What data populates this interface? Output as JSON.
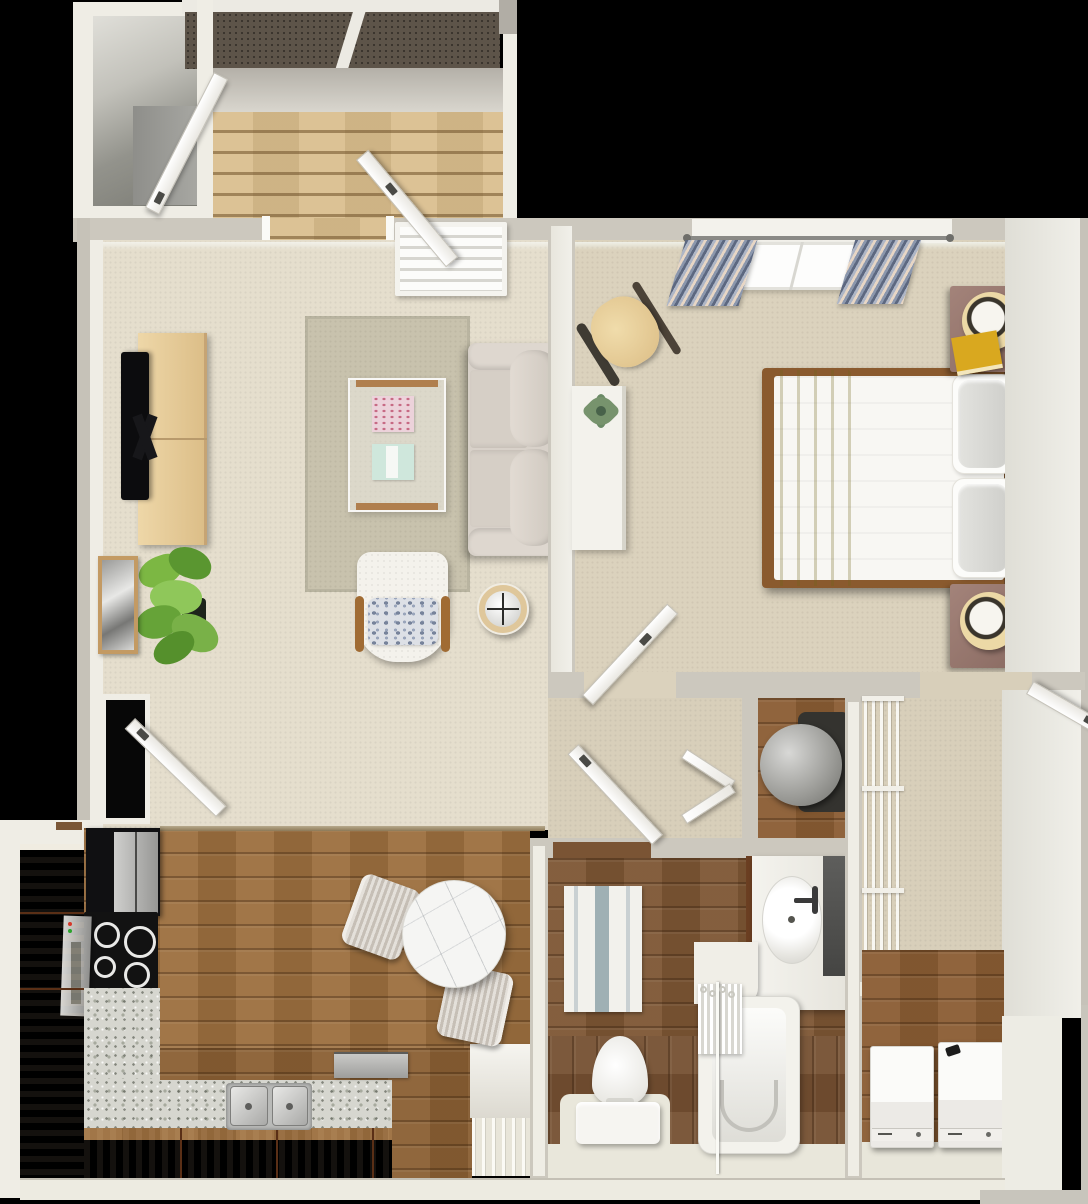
{
  "app": {
    "title": "Top-down 3D rendering of a one-bedroom, one-bathroom apartment floor plan with private entry deck"
  },
  "palette": {
    "background": "#000000",
    "wall_outer": "#ccc8be",
    "wall_face": "#efede5",
    "carpet_living": "#e5decd",
    "carpet_bedroom": "#dbd2bd",
    "carpet_hall": "#d8cfba",
    "rug_living": "#c8c2ad",
    "wood_kitchen": "#9c6f3e",
    "wood_bath": "#7d5634",
    "wood_cabinet": "#7b4326",
    "wood_bar": "#8a5f33",
    "granite": "#d6d6cf",
    "deck_board": "#d9bd8c",
    "roof": "#5d5449",
    "stainless": "#b9bab8",
    "sofa": "#d8d1c9",
    "console": "#e6c995",
    "throw_yellow": "#d3cd6e",
    "nightstand": "#9a7a70",
    "curtain": "#7181a0",
    "marble": "#f5f5f3",
    "heater": "#9a9a96",
    "book_pink": "#ecd2da",
    "book_teal": "#cfe7dc",
    "book_yellow": "#d9a81f",
    "plant_green": "#6fae3e",
    "frame_wood": "#c39a63",
    "tub_white": "#f3f2ec",
    "dark_panel": "#565654"
  },
  "scene": {
    "style": "photoreal 3D dollhouse floor plan viewed from directly above, black background",
    "rooms": [
      {
        "id": "entry-deck",
        "label": "Entry deck with wood decking, roof overhang and open entry doors"
      },
      {
        "id": "stairwell",
        "label": "Exterior stairwell landing"
      },
      {
        "id": "living-room",
        "label": "Living room",
        "furniture": [
          "wall-mounted TV",
          "light wood media console",
          "area rug",
          "glass coffee table with pink and teal books",
          "beige loveseat sofa",
          "white barrel accent chair with patterned pillow",
          "round tray side table",
          "potted plant",
          "framed black-and-white photo",
          "window with white blinds",
          "dark entry closet"
        ]
      },
      {
        "id": "bedroom",
        "label": "Bedroom",
        "furniture": [
          "queen bed with white bedding and chartreuse throw",
          "two mauve nightstands with cream drum lamps",
          "yellow book on nightstand",
          "white desk with succulent",
          "wood desk chair",
          "window with patterned blue curtains",
          "framed pastel abstract art"
        ]
      },
      {
        "id": "kitchen",
        "label": "Galley kitchen",
        "furniture": [
          "black refrigerator with stainless doors",
          "black electric cooktop",
          "L-shaped granite counter",
          "double stainless sink",
          "stainless dishwasher",
          "round marble bistro table",
          "two ribbed upholstered dining chairs",
          "white hutch with slat rack"
        ]
      },
      {
        "id": "hallway",
        "label": "Hallway"
      },
      {
        "id": "utility-closet",
        "label": "Utility closet with water heater and louvered doors"
      },
      {
        "id": "linen-closet",
        "label": "Linen closet with white wire shelving"
      },
      {
        "id": "walk-in-closet",
        "label": "Walk-in closet"
      },
      {
        "id": "bathroom",
        "label": "Bathroom",
        "furniture": [
          "vanity with oval sink and dark splash panel",
          "bathtub with shower curtain and rod",
          "toilet",
          "striped bath rug"
        ]
      },
      {
        "id": "laundry",
        "label": "Laundry room",
        "furniture": [
          "washer",
          "dryer"
        ]
      }
    ],
    "doors": [
      "deck storm door (open)",
      "front entry door (open)",
      "side entry door near kitchen (open)",
      "bathroom door (open)",
      "bedroom door (open)",
      "walk-in closet door (open)",
      "utility closet louvered double doors (ajar)"
    ]
  }
}
